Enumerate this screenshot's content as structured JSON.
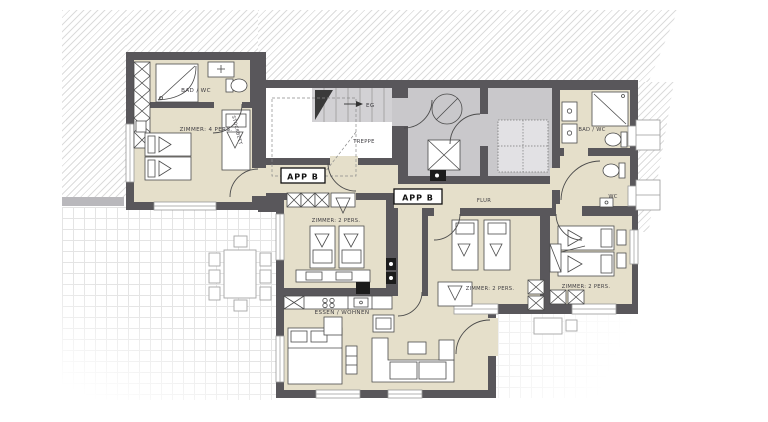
{
  "plan": {
    "apartment": "APP B",
    "floor_marker": "EG",
    "rooms": [
      {
        "id": "bad-wc-left",
        "label": "BAD / WC"
      },
      {
        "id": "zimmer-4-pers",
        "label": "ZIMMER: 4 PERS."
      },
      {
        "id": "treppe",
        "label": "TREPPE"
      },
      {
        "id": "flur",
        "label": "FLUR"
      },
      {
        "id": "bad-wc-right",
        "label": "BAD / WC"
      },
      {
        "id": "wc",
        "label": "WC"
      },
      {
        "id": "zimmer-2-left",
        "label": "ZIMMER: 2 PERS."
      },
      {
        "id": "zimmer-2-mid",
        "label": "ZIMMER: 2 PERS."
      },
      {
        "id": "zimmer-2-right",
        "label": "ZIMMER: 2 PERS."
      },
      {
        "id": "essen-wohnen",
        "label": "ESSEN / WOHNEN"
      }
    ],
    "furniture": {
      "bunk_bed_label": "STOCKBETT"
    },
    "colors": {
      "wall": "#59575b",
      "room_floor": "#e5dfca",
      "common_floor": "#c9c8cb",
      "stair_fill": "#d2d1d4",
      "outdoor_wall": "#b9b8bc",
      "label_text": "#3f3d42"
    }
  }
}
